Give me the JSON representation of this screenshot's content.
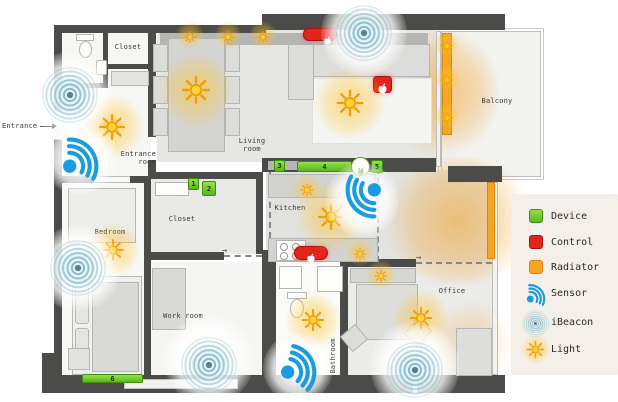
{
  "floorplan": {
    "entrance_label": "Entrance",
    "rooms": {
      "closet_top": "Closet",
      "entrance_room": "Entrance room",
      "living_room": "Living room",
      "balcony": "Balcony",
      "bedroom": "Bedroom",
      "closet_inner": "Closet",
      "kitchen": "Kitchen",
      "work_room": "Work room",
      "bathroom": "Bathroom",
      "office": "Office"
    },
    "devices": [
      {
        "id": "device-1",
        "label": "1"
      },
      {
        "id": "device-2",
        "label": "2"
      },
      {
        "id": "device-3",
        "label": "3"
      },
      {
        "id": "device-4",
        "label": "4"
      },
      {
        "id": "device-5",
        "label": "5"
      },
      {
        "id": "device-6",
        "label": "6"
      }
    ],
    "apple_tv_label": "tv",
    "icons": {
      "door_swing_arrow_icon": "→"
    }
  },
  "legend": {
    "items": [
      {
        "id": "device",
        "label": "Device",
        "color": "#6ec826"
      },
      {
        "id": "control",
        "label": "Control",
        "color": "#e0261c"
      },
      {
        "id": "radiator",
        "label": "Radiator",
        "color": "#f5a623"
      },
      {
        "id": "sensor",
        "label": "Sensor",
        "color": "#1b9ce0"
      },
      {
        "id": "ibeacon",
        "label": "iBeacon",
        "color": "#7eb7cb"
      },
      {
        "id": "light",
        "label": "Light",
        "color": "#f59b00"
      }
    ]
  }
}
